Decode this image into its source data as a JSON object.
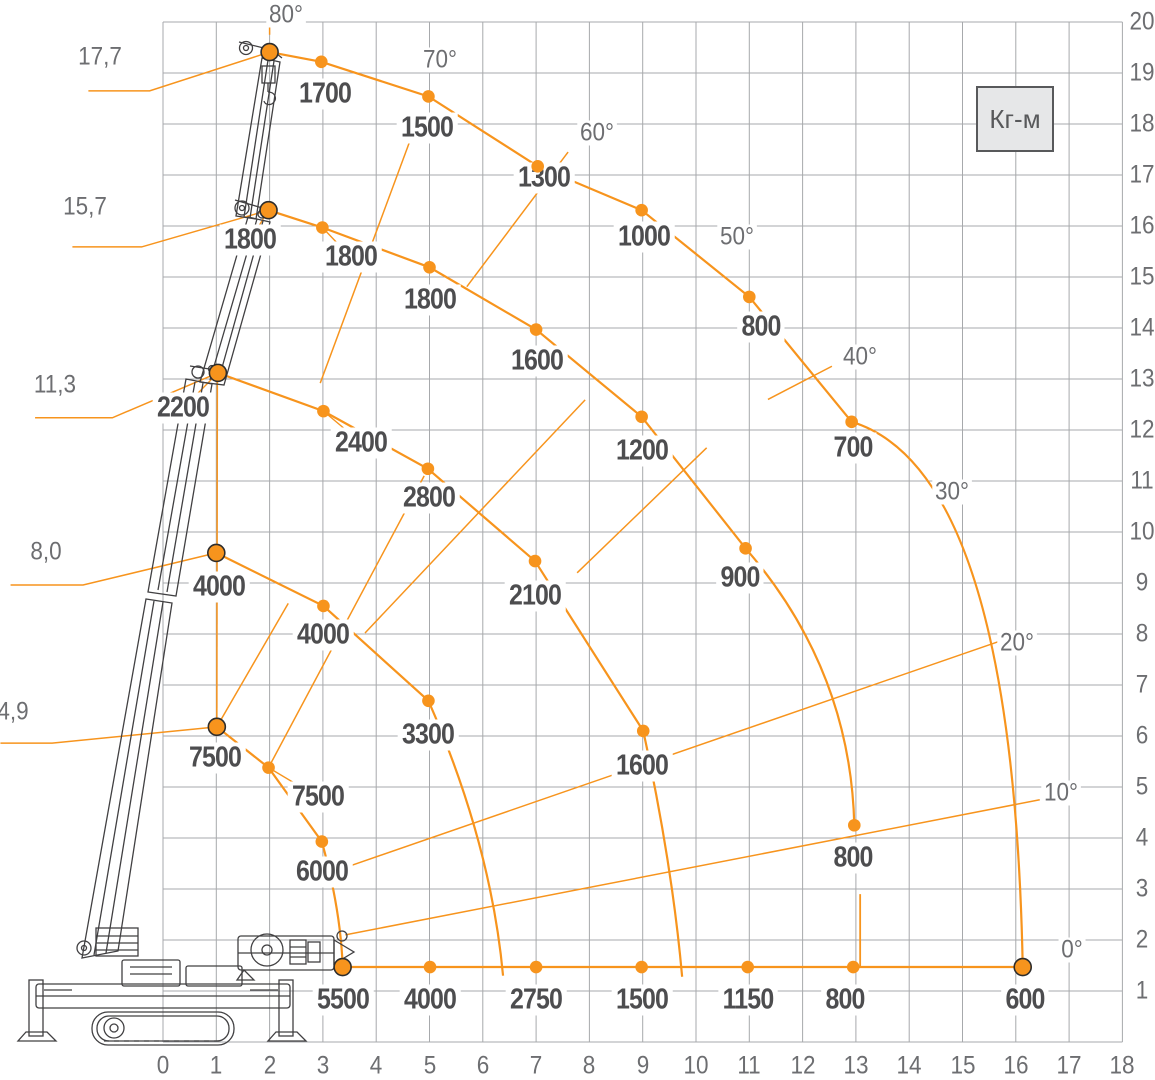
{
  "chart_data": {
    "type": "line",
    "title": "Crane load capacity diagram",
    "unit_box": "Кг-м",
    "layout": {
      "width": 1155,
      "height": 1080,
      "x0": 163,
      "dx": 53.3,
      "y1": 991,
      "dy": 51,
      "x_range": [
        0,
        18
      ],
      "y_range": [
        0,
        20
      ],
      "y_label_px": 1142,
      "x_label_py": 1066,
      "grid_on": true
    },
    "colors": {
      "orange": "#F7941D",
      "grid": "#A7A9AC",
      "text": "#4D4D4F",
      "axis_text": "#6D6E71",
      "crane": "#414042",
      "unit_box_bg": "#E6E7E8",
      "unit_box_border": "#58595B"
    },
    "x_ticks": [
      "0",
      "1",
      "2",
      "3",
      "4",
      "5",
      "6",
      "7",
      "8",
      "9",
      "10",
      "11",
      "12",
      "13",
      "14",
      "15",
      "16",
      "17",
      "18"
    ],
    "y_ticks": [
      "1",
      "2",
      "3",
      "4",
      "5",
      "6",
      "7",
      "8",
      "9",
      "10",
      "11",
      "12",
      "13",
      "14",
      "15",
      "16",
      "17",
      "18",
      "19",
      "20"
    ],
    "angle_labels": [
      {
        "text": "80°",
        "x": 2.3,
        "y": 20.13
      },
      {
        "text": "70°",
        "x": 5.2,
        "y": 19.25
      },
      {
        "text": "60°",
        "x": 8.15,
        "y": 17.82
      },
      {
        "text": "50°",
        "x": 10.77,
        "y": 15.79
      },
      {
        "text": "40°",
        "x": 13.07,
        "y": 13.44
      },
      {
        "text": "30°",
        "x": 14.8,
        "y": 10.78
      },
      {
        "text": "20°",
        "x": 16.02,
        "y": 7.82
      },
      {
        "text": "10°",
        "x": 16.85,
        "y": 4.88
      },
      {
        "text": "0°",
        "x": 17.05,
        "y": 1.8
      }
    ],
    "length_labels": [
      {
        "text": "17,7",
        "x": -1.18,
        "y": 19.31,
        "leader": [
          [
            -1.4,
            18.65
          ],
          [
            -0.25,
            18.65
          ],
          [
            2.0,
            19.41
          ]
        ]
      },
      {
        "text": "15,7",
        "x": -1.46,
        "y": 16.37,
        "leader": [
          [
            -1.7,
            15.59
          ],
          [
            -0.4,
            15.59
          ],
          [
            1.98,
            16.31
          ]
        ]
      },
      {
        "text": "11,3",
        "x": -2.02,
        "y": 12.88,
        "leader": [
          [
            -2.4,
            12.24
          ],
          [
            -0.95,
            12.24
          ],
          [
            1.03,
            13.12
          ]
        ]
      },
      {
        "text": "8,0",
        "x": -2.2,
        "y": 9.61,
        "leader": [
          [
            -2.86,
            8.96
          ],
          [
            -1.5,
            8.96
          ],
          [
            1.0,
            9.59
          ]
        ]
      },
      {
        "text": "4,9",
        "x": -2.81,
        "y": 6.48,
        "leader": [
          [
            -3.05,
            5.86
          ],
          [
            -2.08,
            5.86
          ],
          [
            1.01,
            6.18
          ]
        ]
      }
    ],
    "series": [
      {
        "name": "boom-17.7m",
        "points": [
          {
            "x": 2.0,
            "y": 19.41,
            "big": true
          },
          {
            "x": 2.97,
            "y": 19.22,
            "load": "1700",
            "lx": 3.04,
            "ly": 18.59
          },
          {
            "x": 4.98,
            "y": 18.54,
            "load": "1500",
            "lx": 4.95,
            "ly": 17.92
          },
          {
            "x": 7.03,
            "y": 17.17,
            "load": "1300",
            "lx": 7.15,
            "ly": 16.94
          },
          {
            "x": 8.98,
            "y": 16.31,
            "load": "1000",
            "lx": 9.02,
            "ly": 15.78
          },
          {
            "x": 11.0,
            "y": 14.61,
            "load": "800",
            "lx": 11.22,
            "ly": 14.02
          },
          {
            "x": 12.92,
            "y": 12.16,
            "load": "700",
            "lx": 12.95,
            "ly": 11.65
          }
        ],
        "tail": {
          "c": [
            15.95,
            11.2
          ],
          "end": [
            16.13,
            1.47
          ]
        }
      },
      {
        "name": "boom-15.7m",
        "points": [
          {
            "x": 1.98,
            "y": 16.31,
            "big": true,
            "load": "1800",
            "lx": 1.64,
            "ly": 15.73
          },
          {
            "x": 2.99,
            "y": 15.97,
            "load": "1800",
            "lx": 3.52,
            "ly": 15.39
          },
          {
            "x": 5.0,
            "y": 15.19,
            "load": "1800",
            "lx": 5.0,
            "ly": 14.55
          },
          {
            "x": 7.0,
            "y": 13.97,
            "load": "1600",
            "lx": 7.01,
            "ly": 13.36
          },
          {
            "x": 8.98,
            "y": 12.26,
            "load": "1200",
            "lx": 8.98,
            "ly": 11.58
          },
          {
            "x": 10.93,
            "y": 9.68,
            "load": "900",
            "lx": 10.82,
            "ly": 9.1
          },
          {
            "x": 12.97,
            "y": 4.25,
            "load": "800",
            "lx": 12.94,
            "ly": 3.61
          }
        ],
        "curved": [
          {
            "from": 5,
            "to": 6,
            "c": [
              12.9,
              7.3
            ]
          }
        ],
        "drops": [
          [
            [
              13.08,
              2.9
            ],
            [
              13.08,
              1.47
            ]
          ]
        ]
      },
      {
        "name": "boom-11.3m",
        "points": [
          {
            "x": 1.03,
            "y": 13.12,
            "big": true,
            "load": "2200",
            "lx": 0.38,
            "ly": 12.43
          },
          {
            "x": 3.01,
            "y": 12.37,
            "load": "2400",
            "lx": 3.72,
            "ly": 11.75
          },
          {
            "x": 4.97,
            "y": 11.24,
            "load": "2800",
            "lx": 4.99,
            "ly": 10.67
          },
          {
            "x": 6.98,
            "y": 9.43,
            "load": "2100",
            "lx": 6.98,
            "ly": 8.75
          },
          {
            "x": 9.01,
            "y": 6.1,
            "load": "1600",
            "lx": 8.98,
            "ly": 5.41
          }
        ],
        "tail": {
          "c": [
            9.55,
            3.5
          ],
          "end": [
            9.74,
            1.28
          ]
        }
      },
      {
        "name": "boom-8.0m",
        "points": [
          {
            "x": 1.0,
            "y": 9.59,
            "big": true,
            "load": "4000",
            "lx": 1.06,
            "ly": 8.92
          },
          {
            "x": 3.01,
            "y": 8.55,
            "load": "4000",
            "lx": 3.0,
            "ly": 7.98
          },
          {
            "x": 4.98,
            "y": 6.69,
            "load": "3300",
            "lx": 4.97,
            "ly": 6.02
          }
        ],
        "tail": {
          "c": [
            6.15,
            3.9
          ],
          "end": [
            6.38,
            1.3
          ]
        }
      },
      {
        "name": "boom-4.9m",
        "points": [
          {
            "x": 1.01,
            "y": 6.18,
            "big": true,
            "load": "7500",
            "lx": 0.98,
            "ly": 5.57
          },
          {
            "x": 1.98,
            "y": 5.38,
            "load": "7500",
            "lx": 2.91,
            "ly": 4.8
          },
          {
            "x": 2.98,
            "y": 3.93,
            "load": "6000",
            "lx": 2.99,
            "ly": 3.33
          }
        ],
        "tail": {
          "c": [
            3.33,
            2.6
          ],
          "end": [
            3.37,
            1.5
          ]
        }
      },
      {
        "name": "ground-0deg",
        "points": [
          {
            "x": 3.37,
            "y": 1.47,
            "big": true,
            "load": "5500",
            "lx": 3.37,
            "ly": 0.82
          },
          {
            "x": 5.01,
            "y": 1.47,
            "load": "4000",
            "lx": 5.01,
            "ly": 0.82
          },
          {
            "x": 7.0,
            "y": 1.47,
            "load": "2750",
            "lx": 7.0,
            "ly": 0.82
          },
          {
            "x": 8.98,
            "y": 1.47,
            "load": "1500",
            "lx": 8.98,
            "ly": 0.82
          },
          {
            "x": 10.97,
            "y": 1.47,
            "load": "1150",
            "lx": 10.97,
            "ly": 0.82
          },
          {
            "x": 12.95,
            "y": 1.47,
            "load": "800",
            "lx": 12.8,
            "ly": 0.82
          },
          {
            "x": 16.13,
            "y": 1.47,
            "big": true,
            "load": "600",
            "lx": 16.18,
            "ly": 0.82
          }
        ]
      }
    ],
    "rays": [
      [
        [
          2.0,
          19.75
        ],
        [
          2.0,
          20.05
        ]
      ],
      [
        [
          2.95,
          12.92
        ],
        [
          4.75,
          18.0
        ]
      ],
      [
        [
          5.7,
          14.81
        ],
        [
          7.6,
          17.45
        ]
      ],
      [
        [
          3.79,
          8.02
        ],
        [
          7.92,
          12.59
        ]
      ],
      [
        [
          7.77,
          9.2
        ],
        [
          10.2,
          11.65
        ]
      ],
      [
        [
          11.35,
          12.6
        ],
        [
          12.55,
          13.25
        ]
      ],
      [
        [
          1.98,
          5.38
        ],
        [
          4.9,
          11.1
        ]
      ],
      [
        [
          1.01,
          6.18
        ],
        [
          2.35,
          8.6
        ]
      ],
      [
        [
          3.5,
          3.45
        ],
        [
          15.95,
          7.95
        ]
      ],
      [
        [
          3.42,
          2.1
        ],
        [
          16.45,
          4.75
        ]
      ],
      [
        [
          1.02,
          13.12
        ],
        [
          1.01,
          6.18
        ]
      ]
    ]
  }
}
